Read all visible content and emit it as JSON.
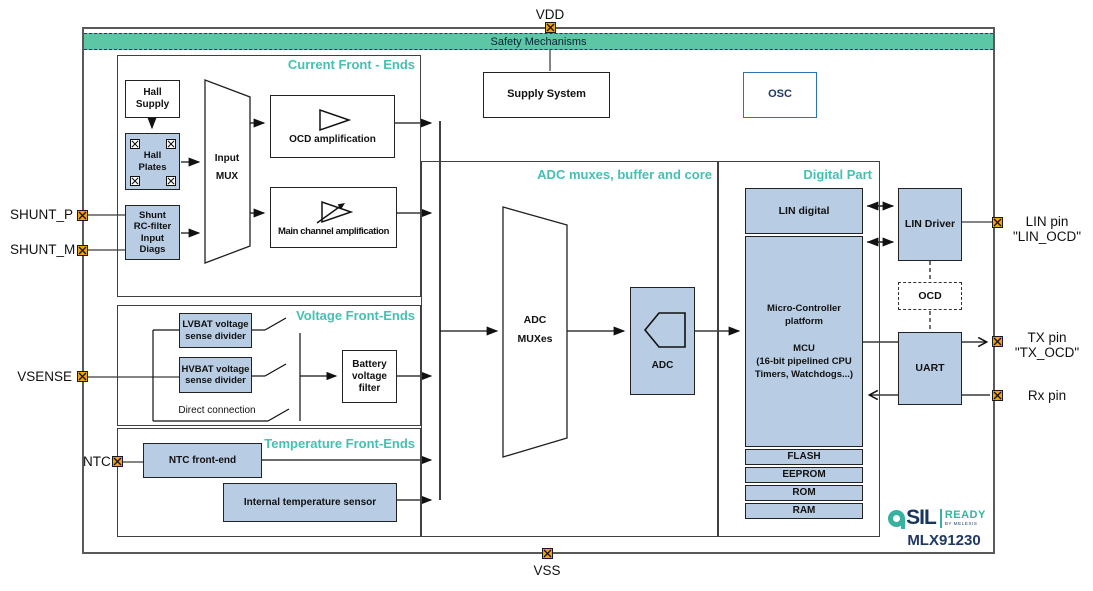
{
  "pins": {
    "vdd": "VDD",
    "vss": "VSS",
    "shunt_p": "SHUNT_P",
    "shunt_m": "SHUNT_M",
    "vsense": "VSENSE",
    "ntc": "NTC",
    "lin_line1": "LIN pin",
    "lin_line2": "\"LIN_OCD\"",
    "tx_line1": "TX pin",
    "tx_line2": "\"TX_OCD\"",
    "rx": "Rx pin"
  },
  "safety": {
    "label": "Safety Mechanisms"
  },
  "top": {
    "supply_system": "Supply System",
    "osc": "OSC"
  },
  "current_fe": {
    "title": "Current Front - Ends",
    "hall_supply": "Hall\nSupply",
    "hall_plates": "Hall\nPlates",
    "shunt": "Shunt\nRC-filter\nInput\nDiags",
    "input_mux": "Input\nMUX",
    "ocd_amp": "OCD amplification",
    "main_amp": "Main channel amplification"
  },
  "voltage_fe": {
    "title": "Voltage Front-Ends",
    "lvbat": "LVBAT voltage\nsense divider",
    "hvbat": "HVBAT voltage\nsense divider",
    "direct": "Direct connection",
    "battery_filter": "Battery\nvoltage\nfilter"
  },
  "temp_fe": {
    "title": "Temperature Front-Ends",
    "ntc_fe": "NTC front-end",
    "int_temp": "Internal temperature sensor"
  },
  "adc_section": {
    "title": "ADC muxes, buffer and core",
    "adc_muxes": "ADC\nMUXes",
    "adc": "ADC"
  },
  "digital": {
    "title": "Digital Part",
    "lin_digital": "LIN digital",
    "mcu": "Micro-Controller\nplatform\n\nMCU\n(16-bit pipelined CPU\nTimers, Watchdogs...)",
    "memory": [
      "FLASH",
      "EEPROM",
      "ROM",
      "RAM"
    ],
    "lin_driver": "LIN Driver",
    "ocd": "OCD",
    "uart": "UART"
  },
  "branding": {
    "part": "MLX91230",
    "logo_sil": "SIL",
    "logo_ready": "READY",
    "logo_by": "BY MELEXIS"
  },
  "colors": {
    "accent_teal": "#45c0b2",
    "safety_green": "#5cc6a5",
    "block_blue": "#b8cce4",
    "pin_orange": "#f0a30a",
    "navy": "#1f3864"
  }
}
